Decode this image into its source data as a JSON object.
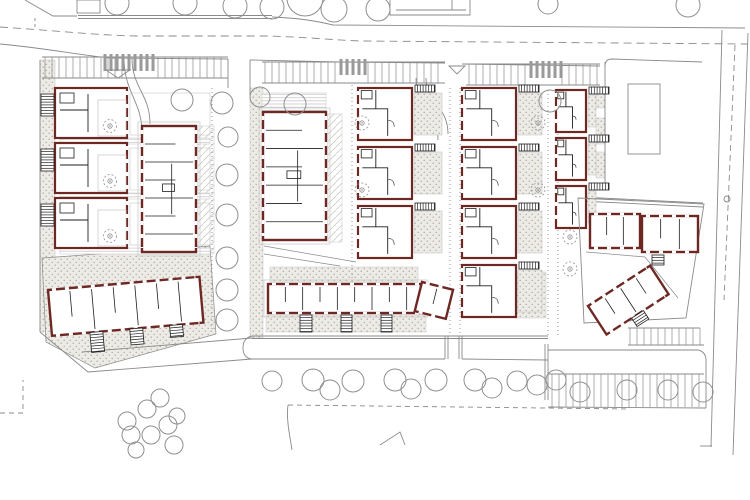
{
  "palette": {
    "bg": "#ffffff",
    "line": "#8a8a8a",
    "faint": "#c6c6c6",
    "wall": "#6e2823",
    "partition": "#1f1f1f",
    "white": "#ffffff",
    "zebra": "#9a9a9a",
    "tree": "#8f8f8f",
    "stipBg": "#edebe6",
    "stipDot": "#a9a59c",
    "deckLine": "#c9c9c9",
    "hatchLine": "#cfccc6"
  },
  "canvas": {
    "w": 750,
    "h": 500
  },
  "layers": {
    "ground": [
      {
        "t": "stip",
        "x": 40,
        "y": 60,
        "w": 15,
        "h": 272
      },
      {
        "t": "stip",
        "x": 250,
        "y": 88,
        "w": 13,
        "h": 250
      },
      {
        "t": "deck",
        "x": 262,
        "y": 93,
        "w": 64,
        "h": 18
      },
      {
        "t": "dh",
        "x": 198,
        "y": 126,
        "w": 16,
        "h": 128
      },
      {
        "t": "dh",
        "x": 328,
        "y": 114,
        "w": 14,
        "h": 128
      },
      {
        "t": "stipPoly",
        "d": "M42,258 L210,246 L216,334 L95,368 L46,342 Z"
      },
      {
        "t": "stip",
        "x": 266,
        "y": 315,
        "w": 160,
        "h": 17
      },
      {
        "t": "stip",
        "x": 270,
        "y": 267,
        "w": 148,
        "h": 15
      },
      {
        "t": "stip",
        "x": 596,
        "y": 92,
        "w": 9,
        "h": 16
      },
      {
        "t": "stip",
        "x": 596,
        "y": 118,
        "w": 9,
        "h": 26
      },
      {
        "t": "stip",
        "x": 596,
        "y": 152,
        "w": 9,
        "h": 26
      },
      {
        "t": "deck",
        "x": 60,
        "y": 138,
        "w": 150,
        "h": 6
      },
      {
        "t": "deck",
        "x": 60,
        "y": 193,
        "w": 150,
        "h": 6
      },
      {
        "t": "deck",
        "x": 60,
        "y": 248,
        "w": 150,
        "h": 6
      },
      {
        "t": "stip",
        "x": 516,
        "y": 272,
        "w": 30,
        "h": 46
      }
    ],
    "roads": [
      {
        "t": "line",
        "x1": 78,
        "y1": 15.5,
        "x2": 272,
        "y2": 15.5
      },
      {
        "t": "line",
        "x1": 78,
        "y1": 18.5,
        "x2": 272,
        "y2": 18.5
      },
      {
        "t": "path",
        "d": "M272,17 C300,18 316,21 333,25 L745,28"
      },
      {
        "t": "path",
        "d": "M0,27 C60,31 95,35 135,36 L268,36 C305,37 332,40 362,41 L748,44",
        "dash": "8 5"
      },
      {
        "t": "path",
        "d": "M0,44 C45,48 78,55 110,58 L228,59"
      },
      {
        "t": "line",
        "x1": 250,
        "y1": 60,
        "x2": 340,
        "y2": 62
      },
      {
        "t": "line",
        "x1": 340,
        "y1": 62,
        "x2": 445,
        "y2": 63
      },
      {
        "t": "line",
        "x1": 462,
        "y1": 64,
        "x2": 600,
        "y2": 66
      },
      {
        "t": "line",
        "x1": 228,
        "y1": 59,
        "x2": 228,
        "y2": 88
      },
      {
        "t": "line",
        "x1": 250,
        "y1": 60,
        "x2": 250,
        "y2": 95
      },
      {
        "t": "path",
        "d": "M132,58 C132,88 150,94 150,124"
      },
      {
        "t": "path",
        "d": "M124,58 C124,92 142,102 142,132"
      },
      {
        "t": "path",
        "d": "M416,78 C416,106 438,110 438,140"
      },
      {
        "t": "path",
        "d": "M426,78 C426,102 448,106 448,134"
      },
      {
        "t": "line",
        "x1": 722,
        "y1": 30,
        "x2": 711,
        "y2": 447
      },
      {
        "t": "line",
        "x1": 748,
        "y1": 33,
        "x2": 733,
        "y2": 455
      },
      {
        "t": "path",
        "d": "M735,45 L724,300",
        "dash": "6 4"
      },
      {
        "t": "line",
        "x1": 700,
        "y1": 446,
        "x2": 712,
        "y2": 446
      },
      {
        "t": "line",
        "x1": 605,
        "y1": 62,
        "x2": 605,
        "y2": 188
      },
      {
        "t": "path",
        "d": "M605,66 Q605,59 612,59 L702,62"
      },
      {
        "t": "line",
        "x1": 580,
        "y1": 197,
        "x2": 703,
        "y2": 203
      },
      {
        "t": "line",
        "x1": 580,
        "y1": 201,
        "x2": 703,
        "y2": 207
      },
      {
        "t": "rect",
        "x": 628,
        "y": 84,
        "w": 32,
        "h": 70
      },
      {
        "t": "circle",
        "cx": 727,
        "cy": 199,
        "r": 3
      },
      {
        "t": "line",
        "x1": 252,
        "y1": 336,
        "x2": 548,
        "y2": 336
      },
      {
        "t": "line",
        "x1": 252,
        "y1": 338.5,
        "x2": 548,
        "y2": 338.5
      },
      {
        "t": "path",
        "d": "M252,336 Q243,338 243,348 Q243,358 252,359"
      },
      {
        "t": "line",
        "x1": 252,
        "y1": 359,
        "x2": 445,
        "y2": 359
      },
      {
        "t": "line",
        "x1": 462,
        "y1": 359,
        "x2": 548,
        "y2": 360
      },
      {
        "t": "line",
        "x1": 445,
        "y1": 336,
        "x2": 445,
        "y2": 359
      },
      {
        "t": "line",
        "x1": 448,
        "y1": 336,
        "x2": 448,
        "y2": 359
      },
      {
        "t": "line",
        "x1": 459,
        "y1": 336,
        "x2": 459,
        "y2": 359
      },
      {
        "t": "line",
        "x1": 462,
        "y1": 336,
        "x2": 462,
        "y2": 359
      },
      {
        "t": "line",
        "x1": 252,
        "y1": 338,
        "x2": 82,
        "y2": 352
      },
      {
        "t": "line",
        "x1": 252,
        "y1": 359,
        "x2": 88,
        "y2": 372
      },
      {
        "t": "line",
        "x1": 40,
        "y1": 332,
        "x2": 88,
        "y2": 372
      },
      {
        "t": "line",
        "x1": 40,
        "y1": 60,
        "x2": 40,
        "y2": 332
      },
      {
        "t": "path",
        "d": "M0,413 L23,413 L23,380",
        "dash": "5 4"
      },
      {
        "t": "path",
        "d": "M288,405 L630,409",
        "dash": "5 4"
      },
      {
        "t": "path",
        "d": "M288,405 C286,420 290,436 292,450"
      },
      {
        "t": "path",
        "d": "M380,445 L400,432 L405,445"
      },
      {
        "t": "path",
        "d": "M25,0 L53,16 L77,16"
      },
      {
        "t": "rect",
        "x": 77,
        "y": 0,
        "w": 23,
        "h": 13
      },
      {
        "t": "path",
        "d": "M35,18 L35,28",
        "dash": "3 3"
      },
      {
        "t": "path",
        "d": "M390,0 L390,15 L470,15 L470,0"
      },
      {
        "t": "line",
        "x1": 396,
        "y1": 10,
        "x2": 466,
        "y2": 10
      },
      {
        "t": "line",
        "x1": 452,
        "y1": 0,
        "x2": 452,
        "y2": 10
      },
      {
        "t": "path",
        "d": "M264,246 L356,262",
        "w": 0.7
      },
      {
        "t": "path",
        "d": "M264,254 L340,266",
        "w": 0.7
      },
      {
        "t": "path",
        "d": "M586,252 L645,257 L678,298",
        "w": 0.7
      },
      {
        "t": "line",
        "x1": 212,
        "y1": 88,
        "x2": 212,
        "y2": 330,
        "dash": "1 3"
      },
      {
        "t": "line",
        "x1": 352,
        "y1": 85,
        "x2": 352,
        "y2": 310,
        "dash": "1 3"
      },
      {
        "t": "line",
        "x1": 450,
        "y1": 88,
        "x2": 450,
        "y2": 336,
        "dash": "1 3"
      },
      {
        "t": "line",
        "x1": 460,
        "y1": 88,
        "x2": 460,
        "y2": 336,
        "dash": "1 3"
      },
      {
        "t": "line",
        "x1": 548,
        "y1": 90,
        "x2": 548,
        "y2": 338,
        "dash": "1 3"
      },
      {
        "t": "line",
        "x1": 558,
        "y1": 90,
        "x2": 558,
        "y2": 338,
        "dash": "1 3"
      }
    ],
    "parking": [
      {
        "t": "line",
        "x1": 42,
        "y1": 57,
        "x2": 228,
        "y2": 57
      },
      {
        "t": "line",
        "x1": 42,
        "y1": 78,
        "x2": 228,
        "y2": 78
      },
      {
        "t": "stalls",
        "x": 45,
        "y": 57,
        "w": 83,
        "h": 21,
        "p": 7
      },
      {
        "t": "stalls",
        "x": 158,
        "y": 57,
        "w": 67,
        "h": 21,
        "p": 7
      },
      {
        "t": "zebra",
        "x": 102,
        "y": 54,
        "w": 50,
        "h": 17
      },
      {
        "t": "tri",
        "p": "106,70 130,70 118,78"
      },
      {
        "t": "line",
        "x1": 262,
        "y1": 62,
        "x2": 445,
        "y2": 62
      },
      {
        "t": "line",
        "x1": 262,
        "y1": 83,
        "x2": 445,
        "y2": 83
      },
      {
        "t": "stalls",
        "x": 265,
        "y": 62,
        "w": 70,
        "h": 21,
        "p": 7
      },
      {
        "t": "stalls",
        "x": 368,
        "y": 62,
        "w": 73,
        "h": 21,
        "p": 7
      },
      {
        "t": "zebra",
        "x": 338,
        "y": 59,
        "w": 28,
        "h": 16
      },
      {
        "t": "tri",
        "p": "449,66 465,66 457,74"
      },
      {
        "t": "line",
        "x1": 466,
        "y1": 64,
        "x2": 600,
        "y2": 64
      },
      {
        "t": "line",
        "x1": 466,
        "y1": 85,
        "x2": 600,
        "y2": 85
      },
      {
        "t": "stalls",
        "x": 469,
        "y": 64,
        "w": 57,
        "h": 21,
        "p": 7
      },
      {
        "t": "zebra",
        "x": 528,
        "y": 61,
        "w": 32,
        "h": 17
      },
      {
        "t": "stalls",
        "x": 562,
        "y": 64,
        "w": 36,
        "h": 21,
        "p": 7
      },
      {
        "t": "line",
        "x1": 545,
        "y1": 344,
        "x2": 545,
        "y2": 400
      },
      {
        "t": "line",
        "x1": 548,
        "y1": 344,
        "x2": 548,
        "y2": 400
      },
      {
        "t": "path",
        "d": "M548,350 L698,350 Q707,352 706,363"
      },
      {
        "t": "line",
        "x1": 548,
        "y1": 374,
        "x2": 704,
        "y2": 374
      },
      {
        "t": "stalls",
        "x": 552,
        "y": 374,
        "w": 150,
        "h": 33,
        "p": 7
      },
      {
        "t": "line",
        "x1": 548,
        "y1": 407,
        "x2": 706,
        "y2": 408
      },
      {
        "t": "line",
        "x1": 706,
        "y1": 363,
        "x2": 706,
        "y2": 408
      },
      {
        "t": "line",
        "x1": 628,
        "y1": 328,
        "x2": 700,
        "y2": 328
      },
      {
        "t": "stalls",
        "x": 630,
        "y": 328,
        "w": 72,
        "h": 17,
        "p": 7
      },
      {
        "t": "line",
        "x1": 628,
        "y1": 345,
        "x2": 704,
        "y2": 345
      }
    ],
    "buildings": [
      {
        "t": "lb",
        "x": 55,
        "y": 88,
        "w": 72,
        "h": 50,
        "n2": 3,
        "pitch": 55
      },
      {
        "t": "col",
        "x": 358,
        "y": 88,
        "w": 54,
        "h": 52,
        "n2": 3,
        "pitch": 59,
        "cw": 34
      },
      {
        "t": "col",
        "x": 462,
        "y": 88,
        "w": 54,
        "h": 52,
        "n2": 4,
        "pitch": 59,
        "cw": 30
      },
      {
        "t": "col",
        "x": 556,
        "y": 90,
        "w": 30,
        "h": 42,
        "n2": 3,
        "pitch": 48,
        "cw": 14
      },
      {
        "t": "slab",
        "x": 142,
        "y": 126,
        "w": 54,
        "h": 126,
        "dir": "h",
        "np": 6,
        "plinth": true
      },
      {
        "t": "slab",
        "x": 263,
        "y": 112,
        "w": 63,
        "h": 128,
        "dir": "h",
        "np": 6,
        "plinth": true
      },
      {
        "t": "slab",
        "x": 268,
        "y": 284,
        "w": 156,
        "h": 29,
        "dir": "v",
        "np": 8,
        "plinth": true
      },
      {
        "t": "rot",
        "tx": 422,
        "ty": 282,
        "a": 14,
        "kids": [
          {
            "t": "slab",
            "x": 0,
            "y": 0,
            "w": 32,
            "h": 30,
            "dir": "v",
            "np": 1
          }
        ]
      },
      {
        "t": "ladder",
        "x": 300,
        "y": 315,
        "w": 12,
        "h": 17,
        "o": "v"
      },
      {
        "t": "ladder",
        "x": 341,
        "y": 315,
        "w": 11,
        "h": 17,
        "o": "v"
      },
      {
        "t": "ladder",
        "x": 381,
        "y": 315,
        "w": 11,
        "h": 17,
        "o": "v"
      },
      {
        "t": "rot",
        "tx": 48,
        "ty": 290,
        "a": -5,
        "kids": [
          {
            "t": "slab",
            "x": 0,
            "y": 0,
            "w": 152,
            "h": 46,
            "dir": "v",
            "np": 6
          },
          {
            "t": "ladder",
            "x": 38,
            "y": 46,
            "w": 13,
            "h": 20,
            "o": "v"
          },
          {
            "t": "ladder",
            "x": 78,
            "y": 46,
            "w": 13,
            "h": 16,
            "o": "v"
          },
          {
            "t": "ladder",
            "x": 118,
            "y": 46,
            "w": 13,
            "h": 12,
            "o": "v"
          }
        ]
      },
      {
        "t": "path",
        "d": "M578,198 L704,204 L686,318 L584,323 Z"
      },
      {
        "t": "slab",
        "x": 590,
        "y": 214,
        "w": 50,
        "h": 34,
        "dir": "v",
        "np": 2
      },
      {
        "t": "slab",
        "x": 642,
        "y": 216,
        "w": 56,
        "h": 36,
        "dir": "v",
        "np": 2
      },
      {
        "t": "rot",
        "tx": 588,
        "ty": 306,
        "a": -33,
        "kids": [
          {
            "t": "slab",
            "x": 0,
            "y": 0,
            "w": 74,
            "h": 34,
            "dir": "v",
            "np": 3
          },
          {
            "t": "ladder",
            "x": 30,
            "y": 34,
            "w": 14,
            "h": 10,
            "o": "v"
          }
        ]
      },
      {
        "t": "ladder",
        "x": 652,
        "y": 255,
        "w": 12,
        "h": 10,
        "o": "v"
      }
    ],
    "trees": [
      [
        117,
        3,
        12
      ],
      [
        185,
        3,
        12
      ],
      [
        235,
        6,
        12
      ],
      [
        272,
        7,
        12
      ],
      [
        305,
        -2,
        18
      ],
      [
        334,
        9,
        13
      ],
      [
        378,
        9,
        12
      ],
      [
        548,
        4,
        10
      ],
      [
        688,
        5,
        12
      ],
      [
        182,
        100,
        11
      ],
      [
        222,
        103,
        11
      ],
      [
        260,
        97,
        10
      ],
      [
        295,
        104,
        11
      ],
      [
        550,
        101,
        11
      ],
      [
        228,
        137,
        10
      ],
      [
        227,
        175,
        11
      ],
      [
        227,
        215,
        11
      ],
      [
        227,
        258,
        11
      ],
      [
        227,
        290,
        11
      ],
      [
        227,
        320,
        11
      ],
      [
        272,
        381,
        10
      ],
      [
        313,
        380,
        11
      ],
      [
        330,
        390,
        10
      ],
      [
        353,
        381,
        11
      ],
      [
        395,
        380,
        11
      ],
      [
        411,
        389,
        10
      ],
      [
        436,
        380,
        11
      ],
      [
        475,
        380,
        11
      ],
      [
        492,
        388,
        10
      ],
      [
        517,
        381,
        10
      ],
      [
        537,
        385,
        10
      ],
      [
        556,
        380,
        10
      ],
      [
        580,
        392,
        10
      ],
      [
        627,
        390,
        10
      ],
      [
        668,
        390,
        10
      ],
      [
        703,
        392,
        10
      ],
      [
        160,
        398,
        9
      ],
      [
        147,
        409,
        9
      ],
      [
        127,
        421,
        9
      ],
      [
        131,
        435,
        9
      ],
      [
        151,
        435,
        9
      ],
      [
        168,
        425,
        9
      ],
      [
        177,
        416,
        8
      ],
      [
        174,
        445,
        9
      ],
      [
        136,
        450,
        8
      ]
    ],
    "dottrees": [
      [
        362,
        123
      ],
      [
        362,
        190
      ],
      [
        538,
        123
      ],
      [
        538,
        190
      ],
      [
        570,
        237
      ],
      [
        570,
        269
      ]
    ]
  }
}
